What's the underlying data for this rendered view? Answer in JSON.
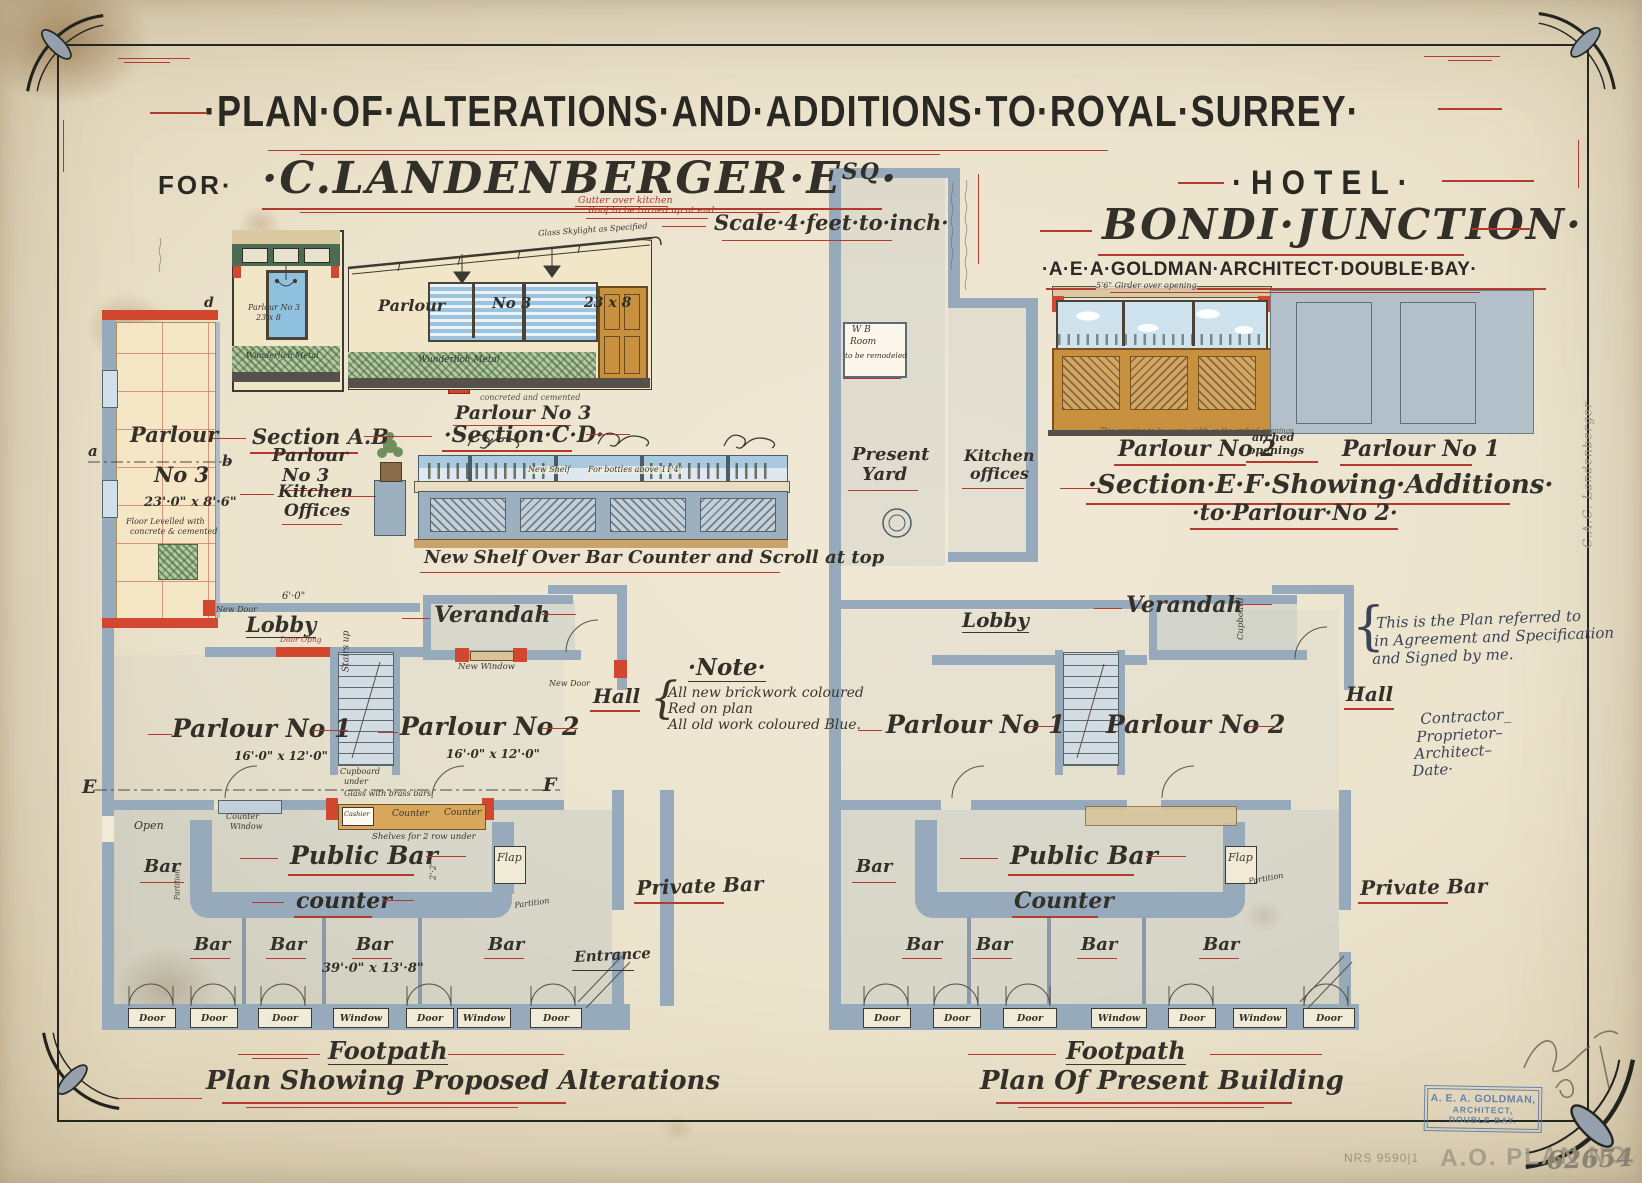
{
  "hdr": {
    "l1": "·PLAN·OF·ALTERATIONS·AND·ADDITIONS·TO·ROYAL·SURREY·",
    "for_label": "FOR·",
    "client": "·C.LANDENBERGER·E",
    "client_sup": "SQ",
    "client_dot": "·",
    "hotel": "·HOTEL·",
    "location": "BONDI·JUNCTION·",
    "architect": "·A·E·A·GOLDMAN·ARCHITECT·DOUBLE·BAY·",
    "scale": "Scale·4·feet·to·inch·"
  },
  "ann": {
    "gutter1": "Gutter over kitchen",
    "gutter2": "Roof to be turned up at end",
    "skylight": "Glass Skylight as Specified",
    "concreted": "concreted and cemented",
    "agree1": "This is the Plan referred to",
    "agree2": "in Agreement and Specification",
    "agree3": "and Signed by me.",
    "contractor": "Contractor_",
    "proprietor": "Proprietor–",
    "architect": "Architect–",
    "date": "Date·",
    "margin": "C.A.C. Landenberger",
    "brace": "{"
  },
  "note": {
    "h": "·Note·",
    "brace": "{",
    "l1": "All new brickwork coloured",
    "l2": "Red on plan",
    "l3": "All old work coloured Blue."
  },
  "sec": {
    "ab": {
      "c1": "Section A.B",
      "c2": "Parlour",
      "c3": "No 3",
      "in1": "Parlour No 3",
      "in2": "23 x 8",
      "dado": "Wunderlich Metal"
    },
    "cd": {
      "room": "Parlour",
      "no": "No 3",
      "dim": "23 x 8",
      "dado": "Wunderlich Metal",
      "cap_room": "Parlour No 3",
      "cap": "·Section·C·D·"
    },
    "shelf": {
      "t1": "New Shelf",
      "t2": "For bottles above 11'4\"",
      "cap": "New Shelf Over Bar Counter and Scroll at top"
    },
    "ef": {
      "girder": "5'6\" Girder over opening",
      "note": "This opening to be same width as the arched openings",
      "p2": "Parlour No 2",
      "a1": "arched",
      "a2": "openings",
      "p1": "Parlour No 1",
      "cap1": "·Section·E·F·Showing·Additions·",
      "cap2": "·to·Parlour·No 2·"
    }
  },
  "lp": {
    "p3a": "Parlour",
    "p3b": "No 3",
    "p3dim": "23'·0\" x 8'·6\"",
    "fl1": "Floor Levelled with",
    "fl2": "concrete & cemented",
    "a": "a",
    "b": "b",
    "d": "d",
    "e": "E",
    "f": "F",
    "kit1": "Kitchen",
    "kit2": "Offices",
    "newdoor": "New Door",
    "dooropng": "Door Opng",
    "lobby": "Lobby",
    "dim6": "6'·0\"",
    "verandah": "Verandah",
    "newwin": "New Window",
    "newdoor2": "New Door",
    "hall": "Hall",
    "p1": "Parlour No 1",
    "p1dim": "16'·0\" x 12'·0\"",
    "p2": "Parlour No 2",
    "p2dim": "16'·0\" x 12'·0\"",
    "stairs": "Stairs up",
    "cb1": "Cupboard",
    "cb2": "under",
    "open": "Open",
    "cw1": "Counter",
    "cw2": "Window",
    "glass": "Glass with brass bars",
    "cashier": "Cashier",
    "cnt1": "Counter",
    "cnt2": "Counter",
    "shelves": "Shelves for 2 row under",
    "bar": "Bar",
    "pub": "Public Bar",
    "flap": "Flap",
    "counter": "counter",
    "dim22": "2'·2\"",
    "part": "Partition",
    "bars": [
      "Bar",
      "Bar",
      "Bar",
      "Bar"
    ],
    "bardim": "39'·0\" x 13'·8\"",
    "entrance": "Entrance",
    "priv": "Private Bar",
    "doors": [
      "Door",
      "Door",
      "Door",
      "Window",
      "Door",
      "Window",
      "Door"
    ],
    "foot": "Footpath",
    "cap": "Plan Showing Proposed Alterations"
  },
  "rp": {
    "wb1": "W B",
    "wb2": "Room",
    "wb3": "to be remodeled",
    "pr1": "Present",
    "pr2": "Yard",
    "kit1": "Kitchen",
    "kit2": "offices",
    "lobby": "Lobby",
    "verandah": "Verandah",
    "hall": "Hall",
    "p1": "Parlour No 1",
    "p2": "Parlour No 2",
    "cup": "Cupboard",
    "bar": "Bar",
    "pub": "Public Bar",
    "flap": "Flap",
    "counter": "Counter",
    "part": "Partition",
    "bars": [
      "Bar",
      "Bar",
      "Bar",
      "Bar"
    ],
    "priv": "Private Bar",
    "doors": [
      "Door",
      "Door",
      "Door",
      "Window",
      "Door",
      "Window",
      "Door"
    ],
    "foot": "Footpath",
    "cap": "Plan Of Present Building"
  },
  "stamp": {
    "g1": "A. E. A. GOLDMAN,",
    "g2": "ARCHITECT,",
    "g3": "DOUBLE BAY.",
    "plan": "A.O. PLAN NO.",
    "planno": "62654",
    "nrs": "NRS 9590|1"
  }
}
